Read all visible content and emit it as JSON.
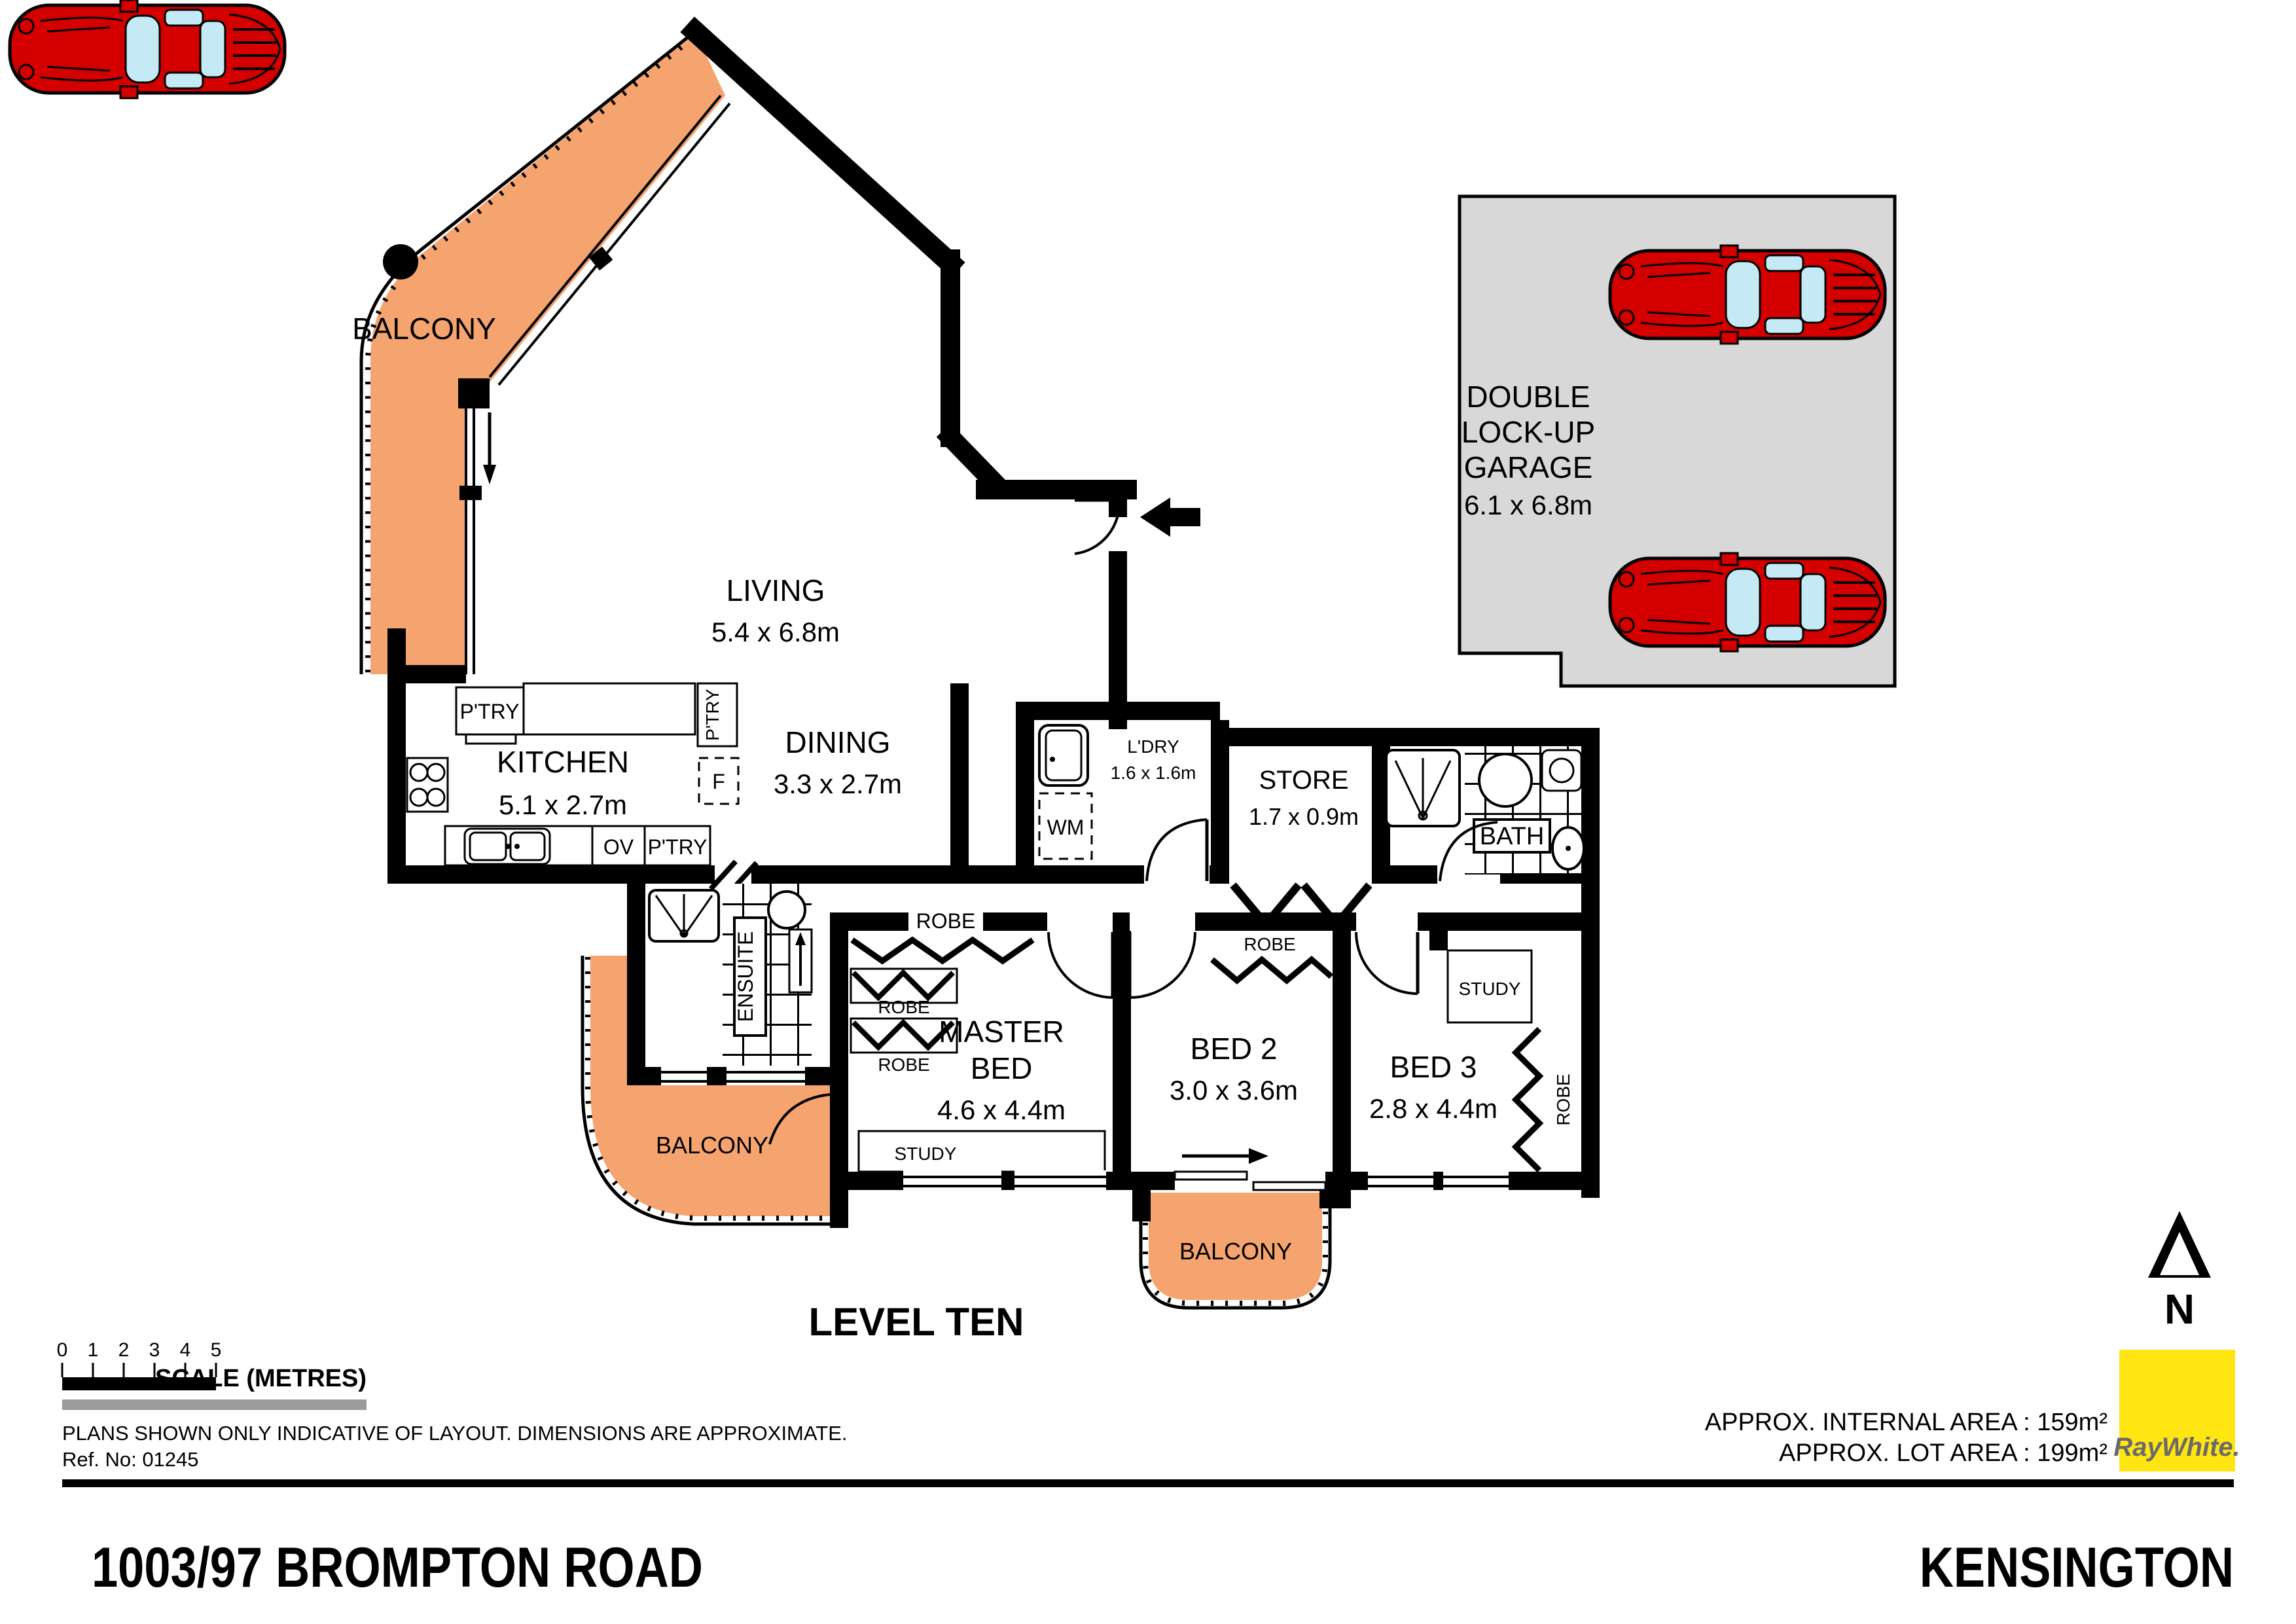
{
  "plan": {
    "balcony": "BALCONY",
    "living": {
      "name": "LIVING",
      "dims": "5.4 x 6.8m"
    },
    "kitchen": {
      "name": "KITCHEN",
      "dims": "5.1 x 2.7m"
    },
    "dining": {
      "name": "DINING",
      "dims": "3.3 x 2.7m"
    },
    "master": {
      "line1": "MASTER",
      "line2": "BED",
      "dims": "4.6 x 4.4m"
    },
    "bed2": {
      "name": "BED 2",
      "dims": "3.0 x 3.6m"
    },
    "bed3": {
      "name": "BED 3",
      "dims": "2.8 x 4.4m"
    },
    "ensuite": "ENSUITE",
    "bath": "BATH",
    "ldry": {
      "name": "L'DRY",
      "dims": "1.6 x 1.6m"
    },
    "store": {
      "name": "STORE",
      "dims": "1.7 x 0.9m"
    },
    "garage": {
      "line1": "DOUBLE",
      "line2": "LOCK-UP",
      "line3": "GARAGE",
      "dims": "6.1 x 6.8m"
    },
    "robe": "ROBE",
    "study": "STUDY",
    "ptry": "P'TRY",
    "ov": "OV",
    "wm": "WM",
    "fridge": "F",
    "level": "LEVEL TEN"
  },
  "scalebar": {
    "ticks": [
      "0",
      "1",
      "2",
      "3",
      "4",
      "5"
    ],
    "label": "SCALE (METRES)"
  },
  "footer": {
    "disclaimer": "PLANS SHOWN ONLY INDICATIVE OF LAYOUT.  DIMENSIONS ARE APPROXIMATE.",
    "ref": "Ref. No: 01245",
    "internal_area": "APPROX. INTERNAL AREA : 159m²",
    "lot_area": "APPROX. LOT AREA : 199m²",
    "address": "1003/97 BROMPTON ROAD",
    "suburb": "KENSINGTON",
    "brand": "RayWhite.",
    "north": "N"
  },
  "colors": {
    "balcony": "#F6A46F",
    "garage_fill": "#D8D8D8",
    "car_red": "#D40000",
    "glass_blue": "#C5EAF6",
    "brand_yellow": "#FFE512",
    "brand_text": "#6A6A6C",
    "walls": "#000000",
    "scale_grey": "#9B9B9B"
  }
}
